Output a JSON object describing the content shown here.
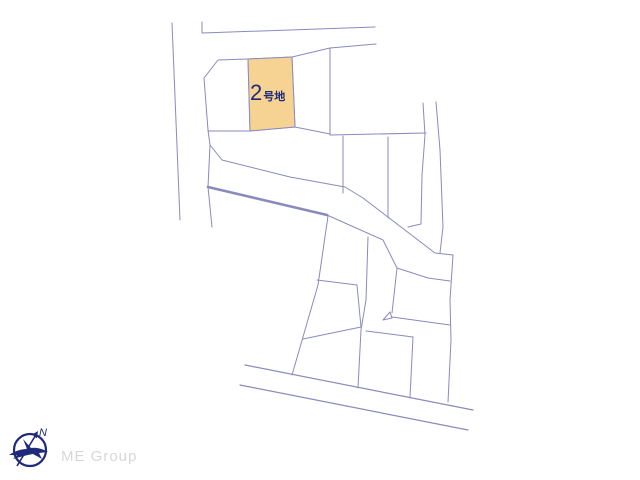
{
  "map": {
    "highlighted_lot": {
      "number": "2",
      "suffix": "号地",
      "fill": "#f6d392",
      "label_color": "#1f2a7b"
    },
    "line_color": "#8a8abd"
  },
  "compass": {
    "north_label": "N",
    "color": "#1f2a7b"
  },
  "branding": {
    "label": "ME Group",
    "color": "#d7d7d7"
  }
}
